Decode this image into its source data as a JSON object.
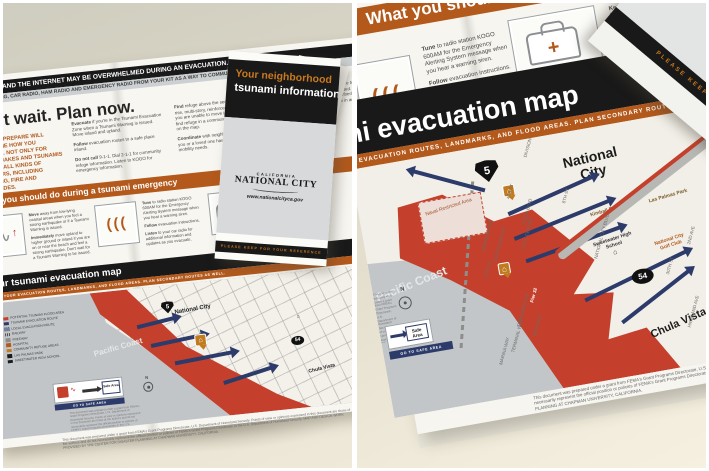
{
  "colors": {
    "accent_orange": "#b3591c",
    "title_orange": "#c8791e",
    "band_black": "#191919",
    "flood_red": "#c4402c",
    "route_navy": "#2c3b6a",
    "water_gray": "#c2c5c8",
    "paper_white": "#f6f5f0",
    "desk_beige": "#e9e3d3"
  },
  "icons": {
    "wave": "∿",
    "person_up": "↑",
    "siren_waves": "(((",
    "first_aid_cross": "+",
    "school_house": "⌂",
    "refuge_house": "⌂",
    "down_arrow": "▼",
    "north": "N"
  },
  "brochure": {
    "banner": {
      "line1": "PHONES AND THE INTERNET MAY BE OVERWHELMED DURING AN EVACUATION.",
      "line2": "USE TEXTING, CAR RADIO, HAM RADIO AND EMERGENCY RADIO FROM YOUR KIT AS A WAY TO COMMUNICATE"
    },
    "plan": {
      "heading": "Don't wait. Plan now.",
      "intro": "HOW YOU PREPARE WILL DETERMINE HOW YOU RECOVER. NOT ONLY FOR EARTHQUAKES AND TSUNAMIS BUT FOR ALL KINDS OF DISASTERS, INCLUDING FLOODING, FIRE AND LANDSLIDES.",
      "items": [
        {
          "lead": "Evacuate",
          "text": "if you're in the Tsunami Evacuation Zone when a Tsunami Warning is issued. Move inland and upland."
        },
        {
          "lead": "Follow",
          "text": "evacuation routes to a safe place inland."
        },
        {
          "lead": "Do not call",
          "text": "9-1-1. Dial 2-1-1 for community refuge information. Listen to KOGO for emergency information."
        },
        {
          "lead": "Find",
          "text": "refuge above the second floor in a high-rise, multi-story, reinforced concrete building if you are unable to move inland. You may also find refuge in a community refuge zone located on the map."
        },
        {
          "lead": "Coordinate",
          "text": "with neighbors and city services if you or a loved one has medical, physical, or mobility needs."
        },
        {
          "lead": "Decide",
          "text": "in advance when and where to meet family members if you are separated. Be sure of your plans. Have a family member/friend who lives outside the zone know in advance where you will relocate."
        }
      ]
    },
    "emergency": {
      "heading": "What you should do during a tsunami emergency",
      "steps": [
        {
          "lead": "Move",
          "text": "away from low-lying coastal areas when you feel a strong earthquake or if a Tsunami Warning is issued."
        },
        {
          "lead": "Immediately",
          "text": "move upland to higher ground or inland if you are on or near the beach and feel a strong earthquake. Don't wait for a Tsunami Warning to be issued."
        },
        {
          "lead": "Tune",
          "text": "to radio station KOGO 600AM for the Emergency Alerting System message when you hear a warning siren."
        },
        {
          "lead": "Follow",
          "text": "evacuation instructions."
        },
        {
          "lead": "Listen",
          "text": "to your car radio for additional information and updates as you evacuate."
        },
        {
          "lead": "Take",
          "text": "your 72-hour emergency kit that you have assembled when you evacuate."
        },
        {
          "lead": "Keep",
          "text": "the items that you would most likely need for evacuation in a backpack, duffle bag or a wheeled cooler in an easily accessible location."
        }
      ]
    },
    "map": {
      "title": "Your tsunami evacuation map",
      "subtitle": "KNOW YOUR EVACUATION ROUTES, LANDMARKS, AND FLOOD AREAS. PLAN SECONDARY ROUTES AS WELL.",
      "ocean": "Pacific Coast",
      "city": "National City",
      "chula_vista": "Chula Vista",
      "i5": "5",
      "hwy54": "54",
      "pier": "Pier 32",
      "naval": "Naval Restricted Area",
      "kimball": "Kimball Park",
      "las_palmas": "Las Palmas Park",
      "school": "Sweetwater High School",
      "golf": "National City Golf Club",
      "safe_area": "Safe Area",
      "safe_strip": "GO TO SAFE AREA",
      "compass": "N",
      "streets": [
        "DIVISION ST",
        "4TH ST",
        "8TH ST",
        "PLAZA BLVD",
        "CIVIC CENTER",
        "24TH ST",
        "30TH ST",
        "CLEVELAND AVE",
        "HARRISON AVE",
        "TIDELANDS AVE",
        "QUAY AVE",
        "TERMINAL WAY",
        "MARINA WAY",
        "NATIONAL CITY BLVD",
        "HIGHLAND AVE",
        "2ND AVE"
      ],
      "legend": [
        "POTENTIAL TSUNAMI FLOOD AREA",
        "TSUNAMI EVACUATION ROUTE",
        "LOCAL EVACUATION ROUTE",
        "RAILWAY",
        "FREEWAY",
        "HOSPITAL",
        "COMMUNITY REFUGE AREAS",
        "LAS PALMAS PARK",
        "SWEETWATER HIGH SCHOOL"
      ]
    },
    "cover": {
      "title1": "Your neighborhood",
      "title2": "tsunami information",
      "logo_state": "CALIFORNIA",
      "logo_city": "NATIONAL CITY",
      "logo_url": "www.nationalcityca.gov",
      "keep": "PLEASE KEEP FOR YOUR REFERENCE"
    },
    "fine_print": "This document was prepared under a grant from FEMA's Grant Programs Directorate, U.S. Department of Homeland Security. Points of view or opinions expressed in this document are those of the authors and do not necessarily represent the official position or policies of FEMA's Grant Programs Directorate or the U.S. Department of Homeland Security. MAP AND DESIGN WORK PROVIDED BY THE CENTER FOR DISASTER PLANNING AT CHAPMAN UNIVERSITY, CALIFORNIA."
  }
}
